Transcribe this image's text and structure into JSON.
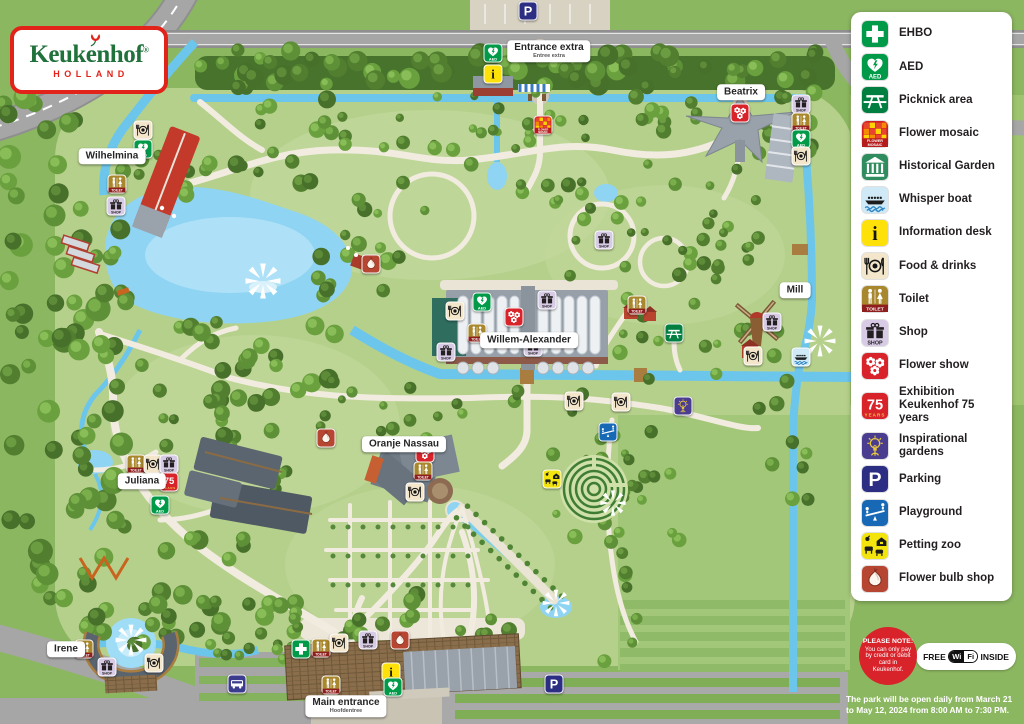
{
  "logo": {
    "brand": "Keukenhof",
    "registered": "®",
    "subtitle": "HOLLAND"
  },
  "legend": {
    "items": [
      {
        "id": "ehbo",
        "label": "EHBO"
      },
      {
        "id": "aed",
        "label": "AED"
      },
      {
        "id": "picnic",
        "label": "Picknick area"
      },
      {
        "id": "mosaic",
        "label": "Flower mosaic"
      },
      {
        "id": "historical",
        "label": "Historical Garden"
      },
      {
        "id": "boat",
        "label": "Whisper boat"
      },
      {
        "id": "info",
        "label": "Information desk"
      },
      {
        "id": "food",
        "label": "Food & drinks"
      },
      {
        "id": "toilet",
        "label": "Toilet"
      },
      {
        "id": "shop",
        "label": "Shop"
      },
      {
        "id": "flowershow",
        "label": "Flower show"
      },
      {
        "id": "seventyfive",
        "label": "Exhibition Keukenhof 75 years"
      },
      {
        "id": "inspiration",
        "label": "Inspirational gardens"
      },
      {
        "id": "parking",
        "label": "Parking"
      },
      {
        "id": "playground",
        "label": "Playground"
      },
      {
        "id": "pettingzoo",
        "label": "Petting zoo"
      },
      {
        "id": "bulbshop",
        "label": "Flower bulb shop"
      }
    ]
  },
  "icon_colors": {
    "ehbo": "#009a49",
    "aed": "#009a49",
    "picnic": "#007f41",
    "mosaic": "#cf2027",
    "historical": "#2e8c5e",
    "boat": "#cfe9f7",
    "info": "#ffe10a",
    "food": "#f3e6cb",
    "toilet": "#a8872d",
    "shop": "#d7cbe6",
    "flowershow": "#d8232a",
    "seventyfive": "#d8232a",
    "inspiration": "#4a3d90",
    "parking": "#2b2e83",
    "playground": "#1768b5",
    "pettingzoo": "#f2e40c",
    "bulbshop": "#b64531",
    "bus": "#3c3c8e"
  },
  "icons": {
    "captions": {
      "aed": "AED",
      "toilet": "TOILET",
      "shop": "SHOP",
      "info": "i",
      "parking": "P",
      "seventyfive_num": "75",
      "seventyfive_years": "YEARS",
      "mosaic1": "FLOWER",
      "mosaic2": "MOSAIC"
    }
  },
  "notice": {
    "title": "PLEASE NOTE:",
    "body": "You can only pay by credit or debit card in Keukenhof."
  },
  "wifi": {
    "free": "FREE",
    "wi": "Wi",
    "fi": "Fi",
    "inside": "INSIDE"
  },
  "opening_hours": "The park will be open daily from March 21 to May 12, 2024 from 8:00 AM to 7:30 PM.",
  "map": {
    "labels": [
      {
        "text": "Wilhelmina",
        "x": 112,
        "y": 156
      },
      {
        "text": "Beatrix",
        "x": 741,
        "y": 92
      },
      {
        "text": "Entrance extra",
        "sub": "Entree extra",
        "x": 549,
        "y": 51
      },
      {
        "text": "Willem-Alexander",
        "x": 529,
        "y": 340
      },
      {
        "text": "Oranje Nassau",
        "x": 404,
        "y": 444
      },
      {
        "text": "Juliana",
        "x": 142,
        "y": 481
      },
      {
        "text": "Irene",
        "x": 66,
        "y": 649
      },
      {
        "text": "Mill",
        "x": 795,
        "y": 290
      },
      {
        "text": "Main entrance",
        "sub": "Hoofdentree",
        "x": 346,
        "y": 706
      }
    ],
    "markers": [
      {
        "t": "parking",
        "x": 528,
        "y": 11
      },
      {
        "t": "aed",
        "x": 493,
        "y": 53
      },
      {
        "t": "info",
        "x": 493,
        "y": 74
      },
      {
        "t": "food",
        "x": 143,
        "y": 130
      },
      {
        "t": "aed",
        "x": 143,
        "y": 149
      },
      {
        "t": "toilet",
        "x": 117,
        "y": 184
      },
      {
        "t": "shop",
        "x": 116,
        "y": 206
      },
      {
        "t": "flowershow",
        "x": 740,
        "y": 113
      },
      {
        "t": "shop",
        "x": 801,
        "y": 104
      },
      {
        "t": "toilet",
        "x": 801,
        "y": 122
      },
      {
        "t": "aed",
        "x": 801,
        "y": 139
      },
      {
        "t": "food",
        "x": 801,
        "y": 156
      },
      {
        "t": "mosaic",
        "x": 543,
        "y": 125
      },
      {
        "t": "shop",
        "x": 604,
        "y": 240
      },
      {
        "t": "bulbshop",
        "x": 371,
        "y": 264
      },
      {
        "t": "shop",
        "x": 547,
        "y": 300
      },
      {
        "t": "aed",
        "x": 482,
        "y": 302
      },
      {
        "t": "food",
        "x": 455,
        "y": 311
      },
      {
        "t": "flowershow",
        "x": 514,
        "y": 317
      },
      {
        "t": "toilet",
        "x": 477,
        "y": 333
      },
      {
        "t": "shop",
        "x": 446,
        "y": 352
      },
      {
        "t": "shop",
        "x": 533,
        "y": 347
      },
      {
        "t": "toilet",
        "x": 637,
        "y": 305
      },
      {
        "t": "picnic",
        "x": 674,
        "y": 333
      },
      {
        "t": "shop",
        "x": 772,
        "y": 322
      },
      {
        "t": "food",
        "x": 753,
        "y": 356
      },
      {
        "t": "boat",
        "x": 801,
        "y": 357
      },
      {
        "t": "food",
        "x": 574,
        "y": 401
      },
      {
        "t": "food",
        "x": 621,
        "y": 402
      },
      {
        "t": "inspiration",
        "x": 683,
        "y": 406
      },
      {
        "t": "playground",
        "x": 608,
        "y": 432
      },
      {
        "t": "pettingzoo",
        "x": 552,
        "y": 479
      },
      {
        "t": "bulbshop",
        "x": 326,
        "y": 438
      },
      {
        "t": "flowershow",
        "x": 425,
        "y": 453
      },
      {
        "t": "toilet",
        "x": 423,
        "y": 471
      },
      {
        "t": "food",
        "x": 415,
        "y": 492
      },
      {
        "t": "toilet",
        "x": 136,
        "y": 464
      },
      {
        "t": "food",
        "x": 153,
        "y": 464
      },
      {
        "t": "shop",
        "x": 169,
        "y": 464
      },
      {
        "t": "seventyfive",
        "x": 169,
        "y": 482
      },
      {
        "t": "aed",
        "x": 160,
        "y": 505
      },
      {
        "t": "toilet",
        "x": 84,
        "y": 649
      },
      {
        "t": "shop",
        "x": 107,
        "y": 667
      },
      {
        "t": "food",
        "x": 154,
        "y": 663
      },
      {
        "t": "ehbo",
        "x": 301,
        "y": 649
      },
      {
        "t": "toilet",
        "x": 321,
        "y": 648
      },
      {
        "t": "food",
        "x": 339,
        "y": 643
      },
      {
        "t": "shop",
        "x": 368,
        "y": 640
      },
      {
        "t": "bulbshop",
        "x": 400,
        "y": 640
      },
      {
        "t": "toilet",
        "x": 331,
        "y": 685
      },
      {
        "t": "info",
        "x": 391,
        "y": 672
      },
      {
        "t": "aed",
        "x": 393,
        "y": 687
      },
      {
        "t": "bus",
        "x": 237,
        "y": 684
      },
      {
        "t": "parking",
        "x": 554,
        "y": 684
      }
    ]
  }
}
